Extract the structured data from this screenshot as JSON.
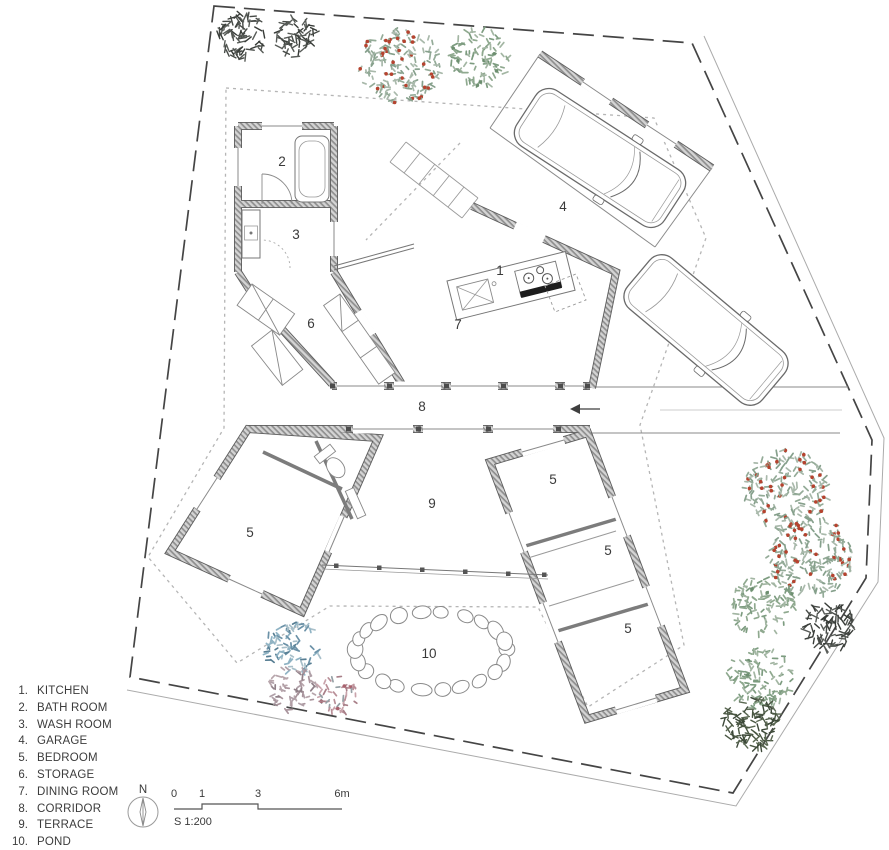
{
  "legend": {
    "items": [
      {
        "number": "1.",
        "label": "KITCHEN"
      },
      {
        "number": "2.",
        "label": "BATH ROOM"
      },
      {
        "number": "3.",
        "label": "WASH ROOM"
      },
      {
        "number": "4.",
        "label": "GARAGE"
      },
      {
        "number": "5.",
        "label": "BEDROOM"
      },
      {
        "number": "6.",
        "label": "STORAGE"
      },
      {
        "number": "7.",
        "label": "DINING ROOM"
      },
      {
        "number": "8.",
        "label": "CORRIDOR"
      },
      {
        "number": "9.",
        "label": "TERRACE"
      },
      {
        "number": "10.",
        "label": "POND"
      }
    ]
  },
  "compass": {
    "label": "N"
  },
  "scale_bar": {
    "ticks": [
      {
        "label": "0",
        "m": 0
      },
      {
        "label": "1",
        "m": 1
      },
      {
        "label": "3",
        "m": 3
      },
      {
        "label": "6m",
        "m": 6
      }
    ],
    "note": "S 1:200",
    "origin_x": 174,
    "bar_y": 809,
    "px_per_m": 28
  },
  "plan": {
    "room_labels": [
      {
        "number": "1",
        "x": 500,
        "y": 275
      },
      {
        "number": "2",
        "x": 282,
        "y": 166
      },
      {
        "number": "3",
        "x": 296,
        "y": 239
      },
      {
        "number": "4",
        "x": 563,
        "y": 211
      },
      {
        "number": "5",
        "x": 250,
        "y": 537
      },
      {
        "number": "5",
        "x": 553,
        "y": 484
      },
      {
        "number": "5",
        "x": 608,
        "y": 555
      },
      {
        "number": "5",
        "x": 628,
        "y": 633
      },
      {
        "number": "6",
        "x": 311,
        "y": 328
      },
      {
        "number": "7",
        "x": 458,
        "y": 329
      },
      {
        "number": "8",
        "x": 422,
        "y": 411
      },
      {
        "number": "9",
        "x": 432,
        "y": 508
      },
      {
        "number": "10",
        "x": 429,
        "y": 658
      }
    ]
  },
  "site": {
    "pond": {
      "cx": 431,
      "cy": 651,
      "rx": 76,
      "ry": 39,
      "stones": 22
    },
    "trees": [
      {
        "x": 242,
        "y": 36,
        "r": 24,
        "palette": "charcoal",
        "style": "scribble"
      },
      {
        "x": 297,
        "y": 38,
        "r": 21,
        "palette": "charcoal",
        "style": "scribble"
      },
      {
        "x": 400,
        "y": 64,
        "r": 41,
        "palette": "redgreen",
        "style": "foliage"
      },
      {
        "x": 479,
        "y": 58,
        "r": 31,
        "palette": "sage",
        "style": "foliage"
      },
      {
        "x": 787,
        "y": 490,
        "r": 43,
        "palette": "redgreen",
        "style": "foliage"
      },
      {
        "x": 810,
        "y": 557,
        "r": 43,
        "palette": "redgreen",
        "style": "foliage"
      },
      {
        "x": 763,
        "y": 606,
        "r": 33,
        "palette": "sage",
        "style": "foliage"
      },
      {
        "x": 830,
        "y": 626,
        "r": 26,
        "palette": "charcoal",
        "style": "scribble"
      },
      {
        "x": 760,
        "y": 678,
        "r": 33,
        "palette": "sage",
        "style": "foliage"
      },
      {
        "x": 751,
        "y": 723,
        "r": 28,
        "palette": "olive",
        "style": "scribble"
      },
      {
        "x": 292,
        "y": 648,
        "r": 29,
        "palette": "blue",
        "style": "foliage"
      },
      {
        "x": 294,
        "y": 689,
        "r": 25,
        "palette": "mauve",
        "style": "foliage"
      },
      {
        "x": 337,
        "y": 694,
        "r": 21,
        "palette": "rose",
        "style": "foliage"
      }
    ],
    "palettes": {
      "charcoal": {
        "strokes": [
          "#474b47",
          "#383c38",
          "#575b57"
        ]
      },
      "redgreen": {
        "strokes": [
          "#94ab98",
          "#a9b9ab",
          "#86a08c"
        ],
        "berry": "#b5432f",
        "berry_p": 0.18
      },
      "sage": {
        "strokes": [
          "#8fa98f",
          "#7d9c80",
          "#a3b6a3"
        ],
        "berry": "#6d8f70",
        "berry_p": 0.05
      },
      "blue": {
        "strokes": [
          "#6c92a8",
          "#577e93",
          "#8fb3c4",
          "#a8bfc9"
        ]
      },
      "mauve": {
        "strokes": [
          "#a9949c",
          "#b7a5ab",
          "#908088",
          "#b0a0a8"
        ]
      },
      "rose": {
        "strokes": [
          "#b98f98",
          "#a87f88",
          "#c9a3ab",
          "#95a0a5"
        ],
        "berry": "#a8626e",
        "berry_p": 0.08
      },
      "olive": {
        "strokes": [
          "#4a5743",
          "#5a6852",
          "#3c4838"
        ]
      }
    }
  },
  "colors": {
    "line_main": "#4a4a4a",
    "line_light": "#8a8a8a",
    "wall_hatch": "#8f8f8f",
    "berry_red": "#b5432f",
    "text": "#3a3a3a"
  }
}
